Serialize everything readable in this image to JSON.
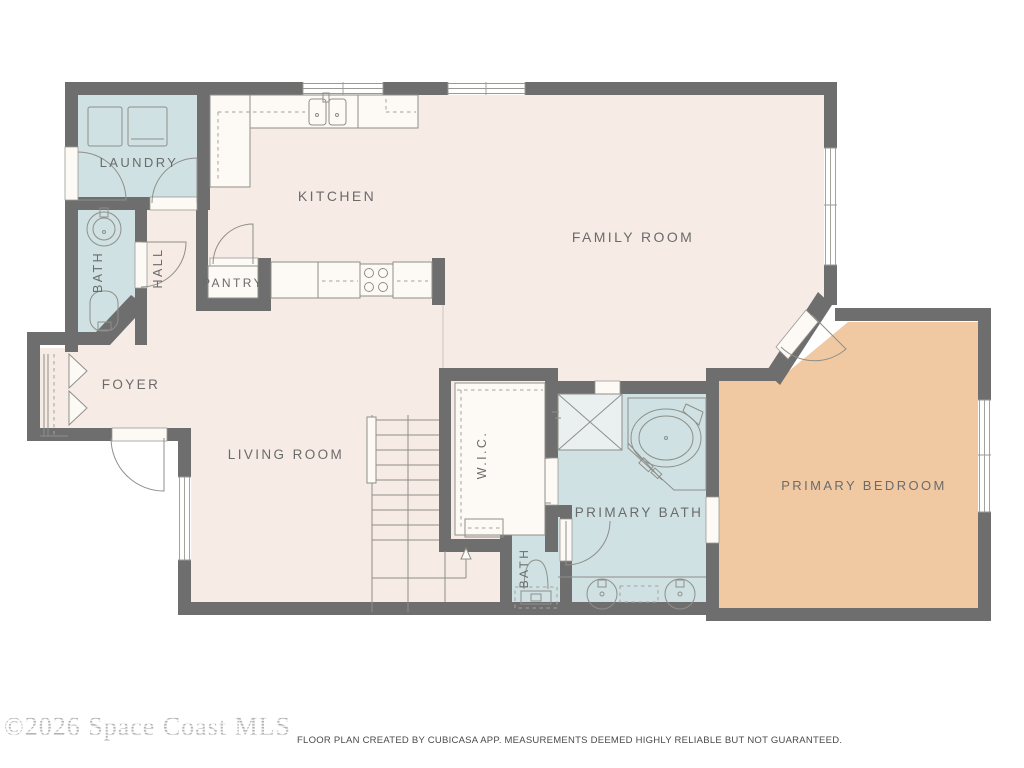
{
  "watermark": "©2026 Space Coast MLS",
  "disclaimer": "FLOOR PLAN CREATED BY CUBICASA APP. MEASUREMENTS DEEMED HIGHLY RELIABLE BUT NOT GUARANTEED.",
  "rooms": {
    "laundry": {
      "label": "LAUNDRY"
    },
    "bath_upper": {
      "label": "BATH"
    },
    "hall": {
      "label": "HALL"
    },
    "kitchen": {
      "label": "KITCHEN"
    },
    "pantry": {
      "label": "PANTRY"
    },
    "family_room": {
      "label": "FAMILY ROOM"
    },
    "foyer": {
      "label": "FOYER"
    },
    "living_room": {
      "label": "LIVING ROOM"
    },
    "wic": {
      "label": "W.I.C."
    },
    "primary_bath": {
      "label": "PRIMARY BATH"
    },
    "bath_lower": {
      "label": "BATH"
    },
    "primary_bedroom": {
      "label": "PRIMARY BEDROOM"
    }
  },
  "colors": {
    "walls": "#6e6e6e",
    "floor": "#f6ece5",
    "wet_rooms": "#cfe1e3",
    "primary_bedroom": "#f0c9a3",
    "fixtures": "#fdfaf5",
    "label_text": "#6b6b6b"
  },
  "fixtures": {
    "laundry": [
      "washer",
      "dryer"
    ],
    "bath_upper": [
      "round-sink",
      "toilet"
    ],
    "kitchen": [
      "double-sink",
      "stove-4-burner",
      "counters",
      "upper-cabinets"
    ],
    "primary_bath": [
      "shower",
      "corner-tub",
      "double-vanity"
    ],
    "bath_lower": [
      "toilet"
    ],
    "stairs": [
      "up-direction-arrow"
    ]
  }
}
